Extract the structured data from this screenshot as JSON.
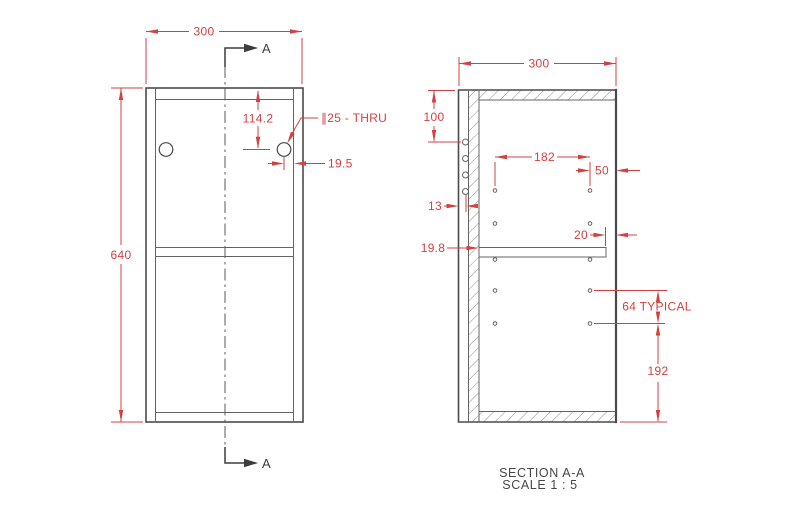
{
  "colors": {
    "dimension": "#d34040",
    "drawing_line": "#4a4a4a",
    "hatch": "#8f8f8f",
    "annotation": "#3d3d3d"
  },
  "front_view": {
    "dim_width": "300",
    "dim_height": "640",
    "dim_hole_from_top": "114.2",
    "hole_callout": "∥25 - THRU",
    "dim_hole_to_edge": "19.5",
    "section_arrow_top_label": "A",
    "section_arrow_bottom_label": "A"
  },
  "section_view": {
    "dim_width": "300",
    "dim_top_to_first_hole": "100",
    "dim_hole_columns_spacing": "182",
    "dim_hole_to_front_edge": "50",
    "dim_back_hole_offset": "13",
    "dim_shelf_thickness": "19.8",
    "dim_shelf_setback": "20",
    "dim_hole_pitch": "64 TYPICAL",
    "dim_last_hole_to_bottom": "192",
    "caption_title": "SECTION A-A",
    "caption_scale": "SCALE 1 : 5"
  }
}
